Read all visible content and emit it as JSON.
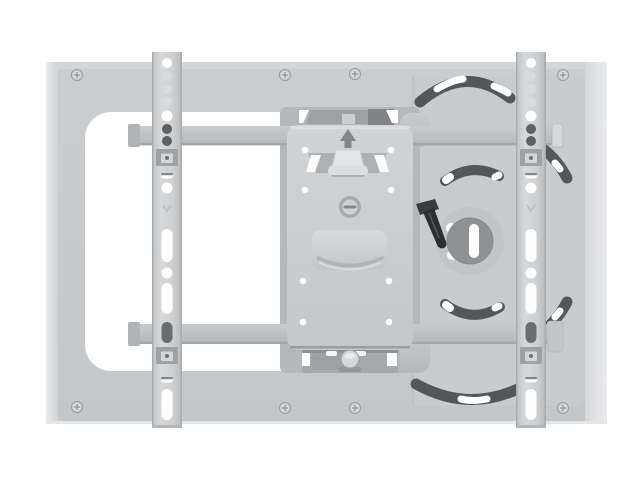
{
  "colors": {
    "background": "#ffffff",
    "white": "#ffffff",
    "plate_face": "#c7cacc",
    "plate_side_left": "#dcdee0",
    "plate_side_right": "#e3e5e6",
    "swivel_plate": "#c9cccf",
    "rail": "#ced1d3",
    "rail_edge": "#a9acae",
    "arm": "#c0c3c5",
    "arm_shadow": "#9da0a3",
    "backing_plate": "#b5b8ba",
    "backing_bottom": "#a6a9ab",
    "hinge_bar": "#9ea1a3",
    "vesa_plate": "#cbced0",
    "recess_panel": "#cfd1d3",
    "knob": "#e2e4e5",
    "dark_slot": "#54575a",
    "disc": "#8f9294",
    "lever": "#2c2f32",
    "screw_head": "#d2d4d6",
    "screw_ring": "#97999c",
    "hole_dark": "#5e6164",
    "hole_light": "#d9dbdd",
    "hole_white": "#fdfdfd",
    "washer": "#9fa2a5"
  },
  "parts": [
    "wall-plate",
    "wall-plate-cutout",
    "mounting-screws",
    "left-tv-rail",
    "right-tv-rail",
    "square-spacers",
    "upper-extension-arm",
    "lower-extension-arm",
    "swivel-plate",
    "tilt-arc-slots",
    "swivel-disc",
    "locking-lever",
    "vesa-adapter-plate",
    "vesa-screw-holes",
    "center-adjustment-screw",
    "cable-recess",
    "tilt-knob",
    "up-arrow-marking"
  ]
}
